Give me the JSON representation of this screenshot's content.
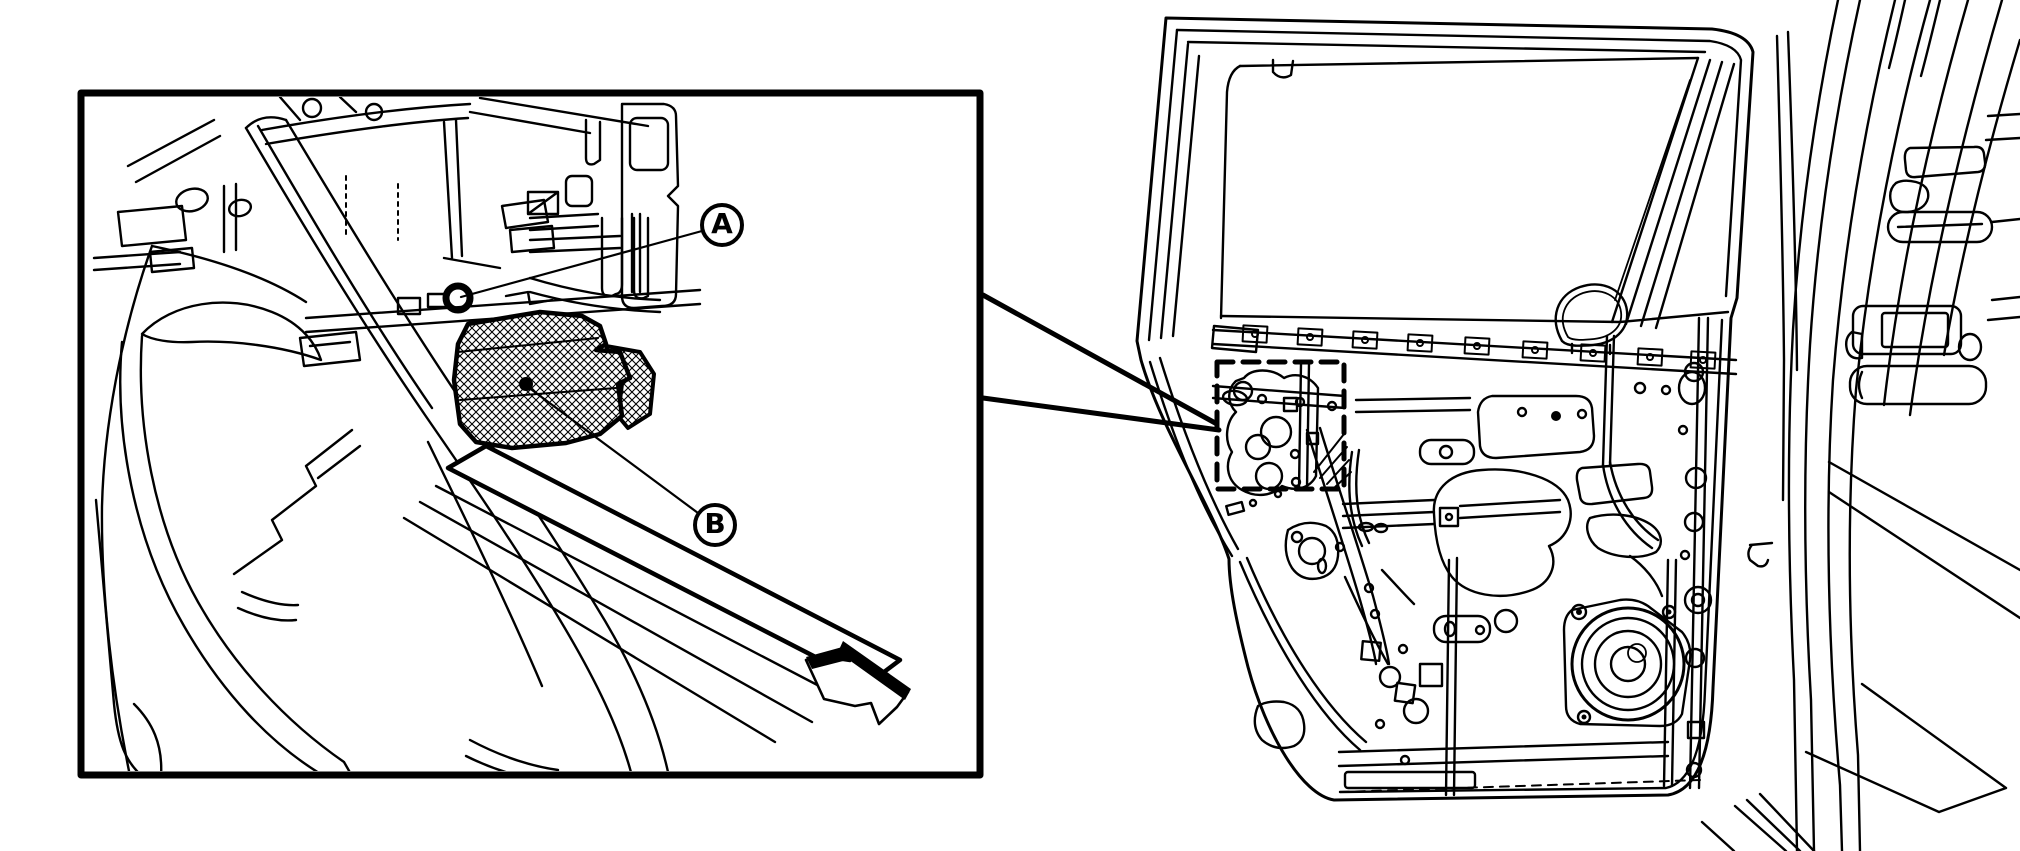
{
  "figure": {
    "background": "#ffffff",
    "ink": "#000000",
    "kind": "service-manual-line-art",
    "panels": {
      "inset": "magnified-detail-of-door-lower-corner",
      "main": "rear-door-inner-panel-with-body-opening"
    }
  },
  "inset": {
    "labels": [
      {
        "id": "A",
        "text": "A"
      },
      {
        "id": "B",
        "text": "B"
      }
    ],
    "arrow_icon": "vehicle-direction-arrow",
    "hatched_part": "sensor-bracket-crosshatched",
    "bolt_marker": "grommet-ring"
  },
  "callout": {
    "style": "dashed-rectangle",
    "connector": "two-converging-thick-lines"
  }
}
